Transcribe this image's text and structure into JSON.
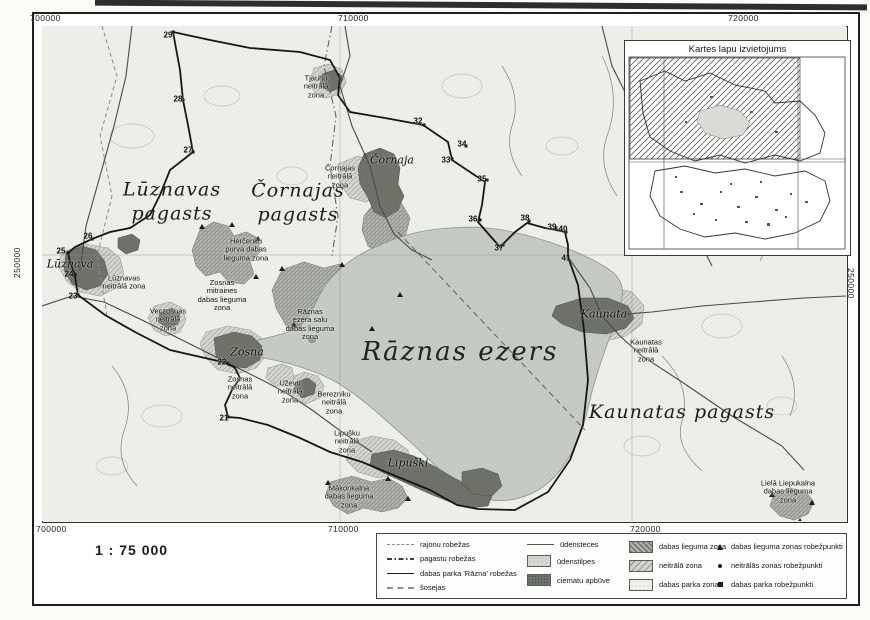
{
  "map": {
    "scale_text": "1 : 75 000",
    "lake_label": "Rāznas ezers",
    "coords": {
      "top": [
        "700000",
        "710000",
        "720000"
      ],
      "bottom": [
        "700000",
        "710000",
        "720000"
      ],
      "left": "250000",
      "right": "250000"
    },
    "parishes": {
      "luznavas": "Lūznavas\npagasts",
      "cornajas": "Čornajas\npagasts",
      "kaunatas": "Kaunatas pagasts"
    },
    "villages": {
      "luznava": "Lūznava",
      "cornaja": "Čornaja",
      "zosna": "Zosna",
      "kaunata": "Kaunata",
      "lipuski": "Lipuški"
    },
    "zone_labels": {
      "tjauhu": "Tjauhu\nneitrālā\nzona",
      "cornajas_nz": "Čornajas\nneitrālā\nzona",
      "luznavas_nz": "Lūznavas\nneitrālā zona",
      "hercenku": "Herčenku\npurva dabas\nlieguma zona",
      "zosnas_mitraines": "Zosnas\nmitraines\ndabas lieguma\nzona",
      "veczosnas_nz": "Veczosnas\nneitrālā\nzona",
      "zosnas_nz": "Zosnas\nneitrālā\nzona",
      "uzevu_nz": "Uževu\nneitrālā\nzona",
      "berezniku_nz": "Berezniku\nneitrālā\nzona",
      "raznas_salu": "Rāznas\nezera salu\ndabas lieguma\nzona",
      "lipusku_nz": "Lipušku\nneitrālā\nzona",
      "makonkalna": "Mākoņkalna\ndabas lieguma\nzona",
      "kaunatas_nz": "Kaunatas\nneitrālā\nzona",
      "liela_liepukalna": "Lielā Liepukalna\ndabas lieguma\nzona"
    },
    "points": [
      {
        "n": "29"
      },
      {
        "n": "28"
      },
      {
        "n": "27"
      },
      {
        "n": "26"
      },
      {
        "n": "25"
      },
      {
        "n": "24"
      },
      {
        "n": "23"
      },
      {
        "n": "22"
      },
      {
        "n": "21"
      },
      {
        "n": "32"
      },
      {
        "n": "33"
      },
      {
        "n": "34"
      },
      {
        "n": "35"
      },
      {
        "n": "36"
      },
      {
        "n": "37"
      },
      {
        "n": "38"
      },
      {
        "n": "39"
      },
      {
        "n": "40"
      },
      {
        "n": "41"
      }
    ]
  },
  "inset": {
    "title": "Kartes lapu izvietojums"
  },
  "legend": {
    "lines": [
      "rajonu robežas",
      "pagastu robežas",
      "dabas parka 'Rāzna' robežas",
      "šosejas"
    ],
    "water": [
      "ūdensteces",
      "ūdenstilpes",
      "ciematu apbūve"
    ],
    "zones": [
      "dabas lieguma zona",
      "neitrālā zona",
      "dabas parka zona"
    ],
    "points": [
      "dabas lieguma zonas robežpunkti",
      "neitrālās zonas robežpunkti",
      "dabas parka robežpunkti"
    ]
  }
}
